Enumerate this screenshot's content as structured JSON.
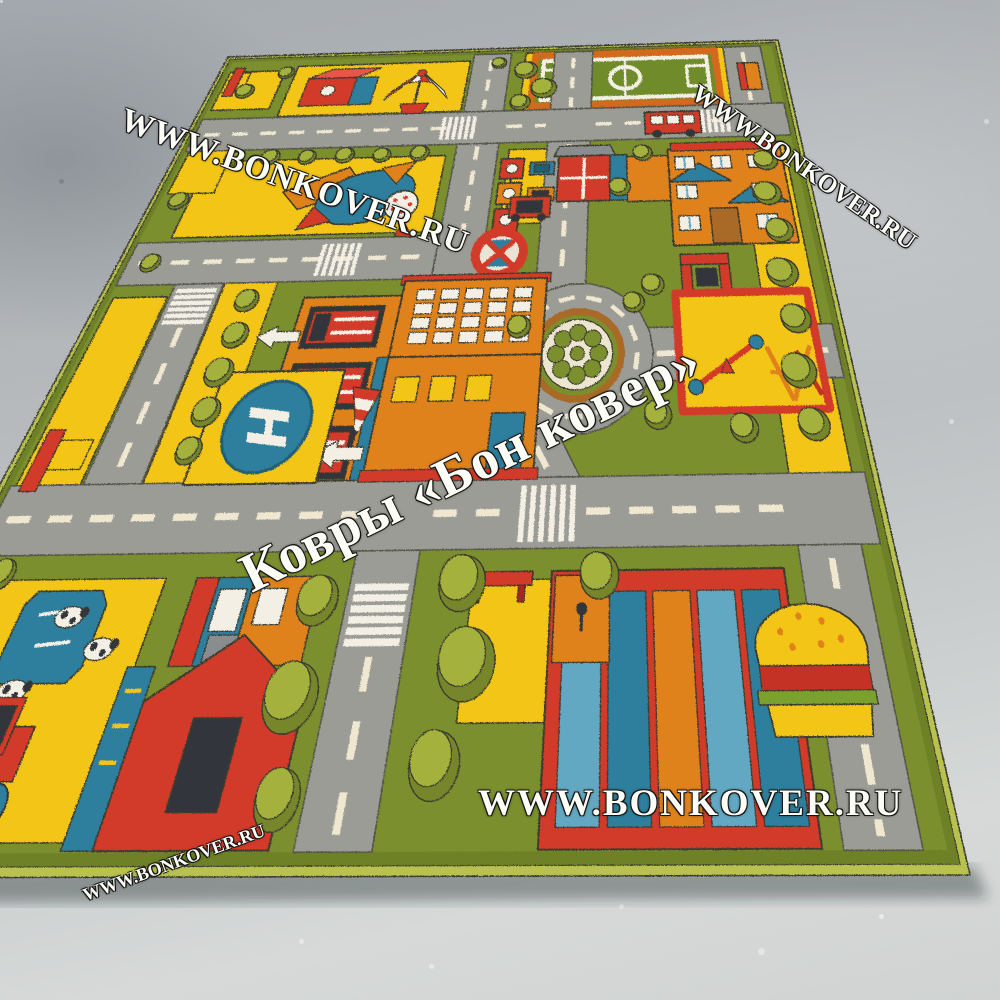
{
  "scene": {
    "description": "children's city road play rug photographed at an angle on a concrete floor",
    "floor_colors": {
      "light": "#d6d9d8",
      "mid": "#b3b7ba",
      "dark": "#989da3"
    }
  },
  "watermarks": {
    "brand_script": "Ковры «Бон ковер»",
    "site_url_top_left": "WWW.BONKOVER.RU",
    "site_url_top_right": "WWW.BONKOVER.RU",
    "site_url_bottom_center": "WWW.BONKOVER.RU",
    "site_url_bottom_left": "WWW.BONKOVER.RU"
  },
  "rug": {
    "helipad_letter": "H",
    "elements": [
      "carousel",
      "toy-blocks",
      "airplane",
      "football-field",
      "traffic-lights",
      "no-stopping-sign",
      "roundabout",
      "helipad",
      "windsock",
      "fire-station",
      "school-building",
      "arch-gate",
      "playground",
      "park-benches",
      "farm-field",
      "cows",
      "pond",
      "tractor",
      "barn",
      "shopping-center",
      "hamburger-kiosk",
      "roads",
      "crosswalks",
      "direction-arrows",
      "trees",
      "cars",
      "bus"
    ],
    "colors": {
      "binding": "#b9c24f",
      "grass": "#7b8f2e",
      "grass_dark": "#6e8128",
      "road": "#9c9c96",
      "road_edge": "#55554a",
      "dash": "#efe7d0",
      "outline": "#3b3b2e",
      "yellow": "#f3c512",
      "red": "#d23a2c",
      "red_light": "#e8564a",
      "dark_red": "#a8251a",
      "orange": "#e0821f",
      "teal": "#2f7f9d",
      "teal_light": "#62a8c2",
      "blue_dark": "#235e76",
      "white": "#f3efe4",
      "tree_light": "#a4b23d",
      "tree_dark": "#77862c",
      "pitch": "#6f8c2a",
      "pitch_border": "#d2691e",
      "brown": "#a86a28",
      "dark": "#33363b",
      "gray": "#8a8d90",
      "lettuce": "#7aa12f",
      "shadow": "rgba(30,34,40,0.38)"
    }
  }
}
